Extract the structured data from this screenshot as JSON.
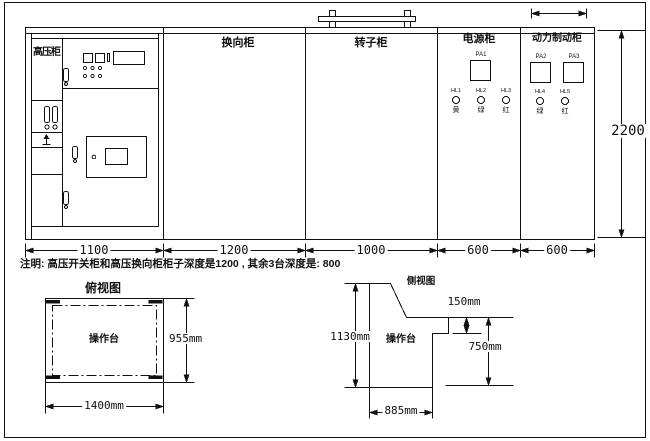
{
  "front_view": {
    "cabinets": [
      {
        "label": "高压柜"
      },
      {
        "label": "换向柜"
      },
      {
        "label": "转子柜"
      },
      {
        "label": "电源柜"
      },
      {
        "label": "动力制动柜"
      }
    ],
    "power_cabinet": {
      "meter": "PA1",
      "lamps": [
        {
          "id": "HL1",
          "color": "黄"
        },
        {
          "id": "HL2",
          "color": "绿"
        },
        {
          "id": "HL3",
          "color": "红"
        }
      ]
    },
    "brake_cabinet": {
      "meters": [
        "PA2",
        "PA3"
      ],
      "lamps": [
        {
          "id": "HL4",
          "color": "绿"
        },
        {
          "id": "HL5",
          "color": "红"
        }
      ]
    },
    "width_dims": [
      "1100",
      "1200",
      "1000",
      "600",
      "600"
    ],
    "height_dim": "2200"
  },
  "note": "注明: 高压开关柜和高压换向柜柜子深度是1200 , 其余3台深度是: 800",
  "top_view": {
    "title": "俯视图",
    "label": "操作台",
    "depth_dim": "955mm",
    "width_dim": "1400mm"
  },
  "side_view": {
    "title": "侧视图",
    "label": "操作台",
    "height_dim": "1130mm",
    "step_dim": "150mm",
    "desk_height_dim": "750mm",
    "depth_dim": "885mm"
  }
}
